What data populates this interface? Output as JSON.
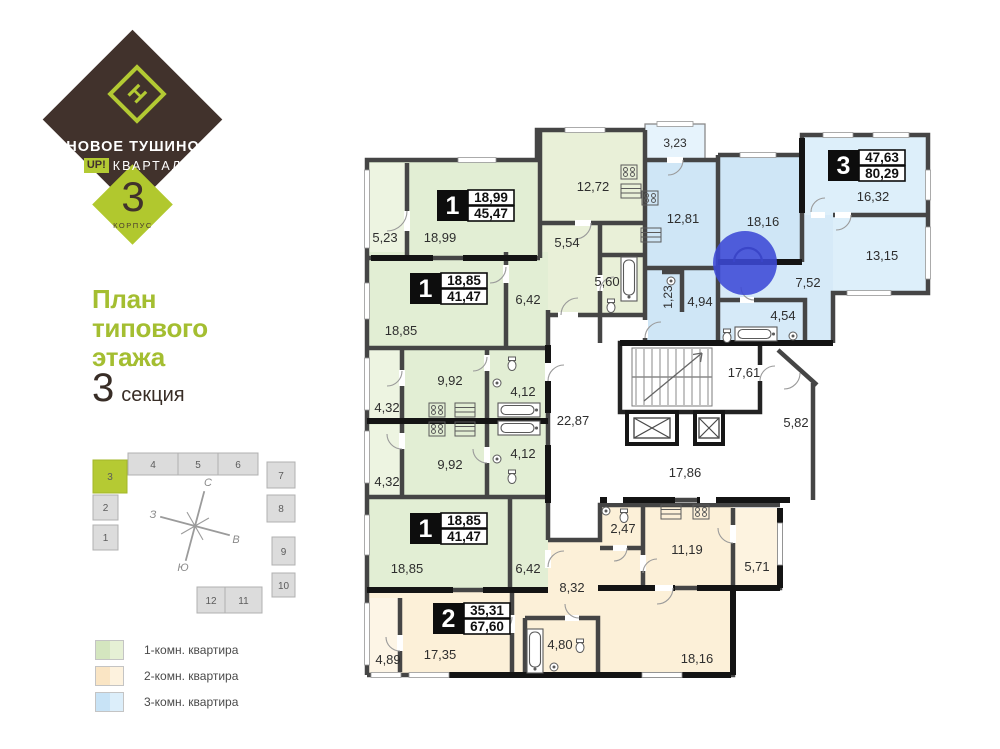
{
  "branding": {
    "project": "НОВОЕ ТУШИНО",
    "up": "UP!",
    "kvartal": "КВАРТАЛ",
    "logo_glyph": "Н",
    "building_number": "3",
    "building_label": "КОРПУС",
    "brand_brown": "#41322c",
    "brand_green": "#b3ca33"
  },
  "title": {
    "line1": "План",
    "line2": "типового",
    "line3": "этажа",
    "section_number": "3",
    "section_label": "секция"
  },
  "site_map": {
    "sections": [
      "1",
      "2",
      "3",
      "4",
      "5",
      "6",
      "7",
      "8",
      "9",
      "10",
      "11",
      "12"
    ],
    "highlighted_section": "3",
    "compass": {
      "n": "С",
      "s": "Ю",
      "w": "З",
      "e": "В"
    }
  },
  "legend": [
    {
      "label": "1-комн. квартира",
      "color_a": "#d4e6bf",
      "color_b": "#e6f0d5"
    },
    {
      "label": "2-комн. квартира",
      "color_a": "#fae5c4",
      "color_b": "#fdf2de"
    },
    {
      "label": "3-комн. квартира",
      "color_a": "#c8e3f6",
      "color_b": "#dceefa"
    }
  ],
  "plan": {
    "apartments": [
      {
        "number": "1",
        "living": "18,99",
        "total": "45,47"
      },
      {
        "number": "1",
        "living": "18,85",
        "total": "41,47"
      },
      {
        "number": "1",
        "living": "18,85",
        "total": "41,47"
      },
      {
        "number": "2",
        "living": "35,31",
        "total": "67,60"
      },
      {
        "number": "3",
        "living": "47,63",
        "total": "80,29"
      }
    ],
    "rooms": [
      "5,23",
      "18,99",
      "12,72",
      "5,54",
      "5,60",
      "3,23",
      "12,81",
      "18,16",
      "16,32",
      "13,15",
      "7,52",
      "4,94",
      "1,23",
      "4,54",
      "17,61",
      "5,82",
      "22,87",
      "17,86",
      "6,42",
      "18,85",
      "9,92",
      "4,32",
      "4,12",
      "9,92",
      "4,32",
      "4,12",
      "18,85",
      "6,42",
      "2,47",
      "11,19",
      "5,71",
      "8,32",
      "4,80",
      "18,16",
      "17,35",
      "4,89"
    ],
    "colors": {
      "one_room": "#e2eed4",
      "two_room": "#fcf0d8",
      "three_room": "#cfe6f6",
      "walls": "#454545"
    },
    "selection_marker_color": "#3c49d6"
  }
}
